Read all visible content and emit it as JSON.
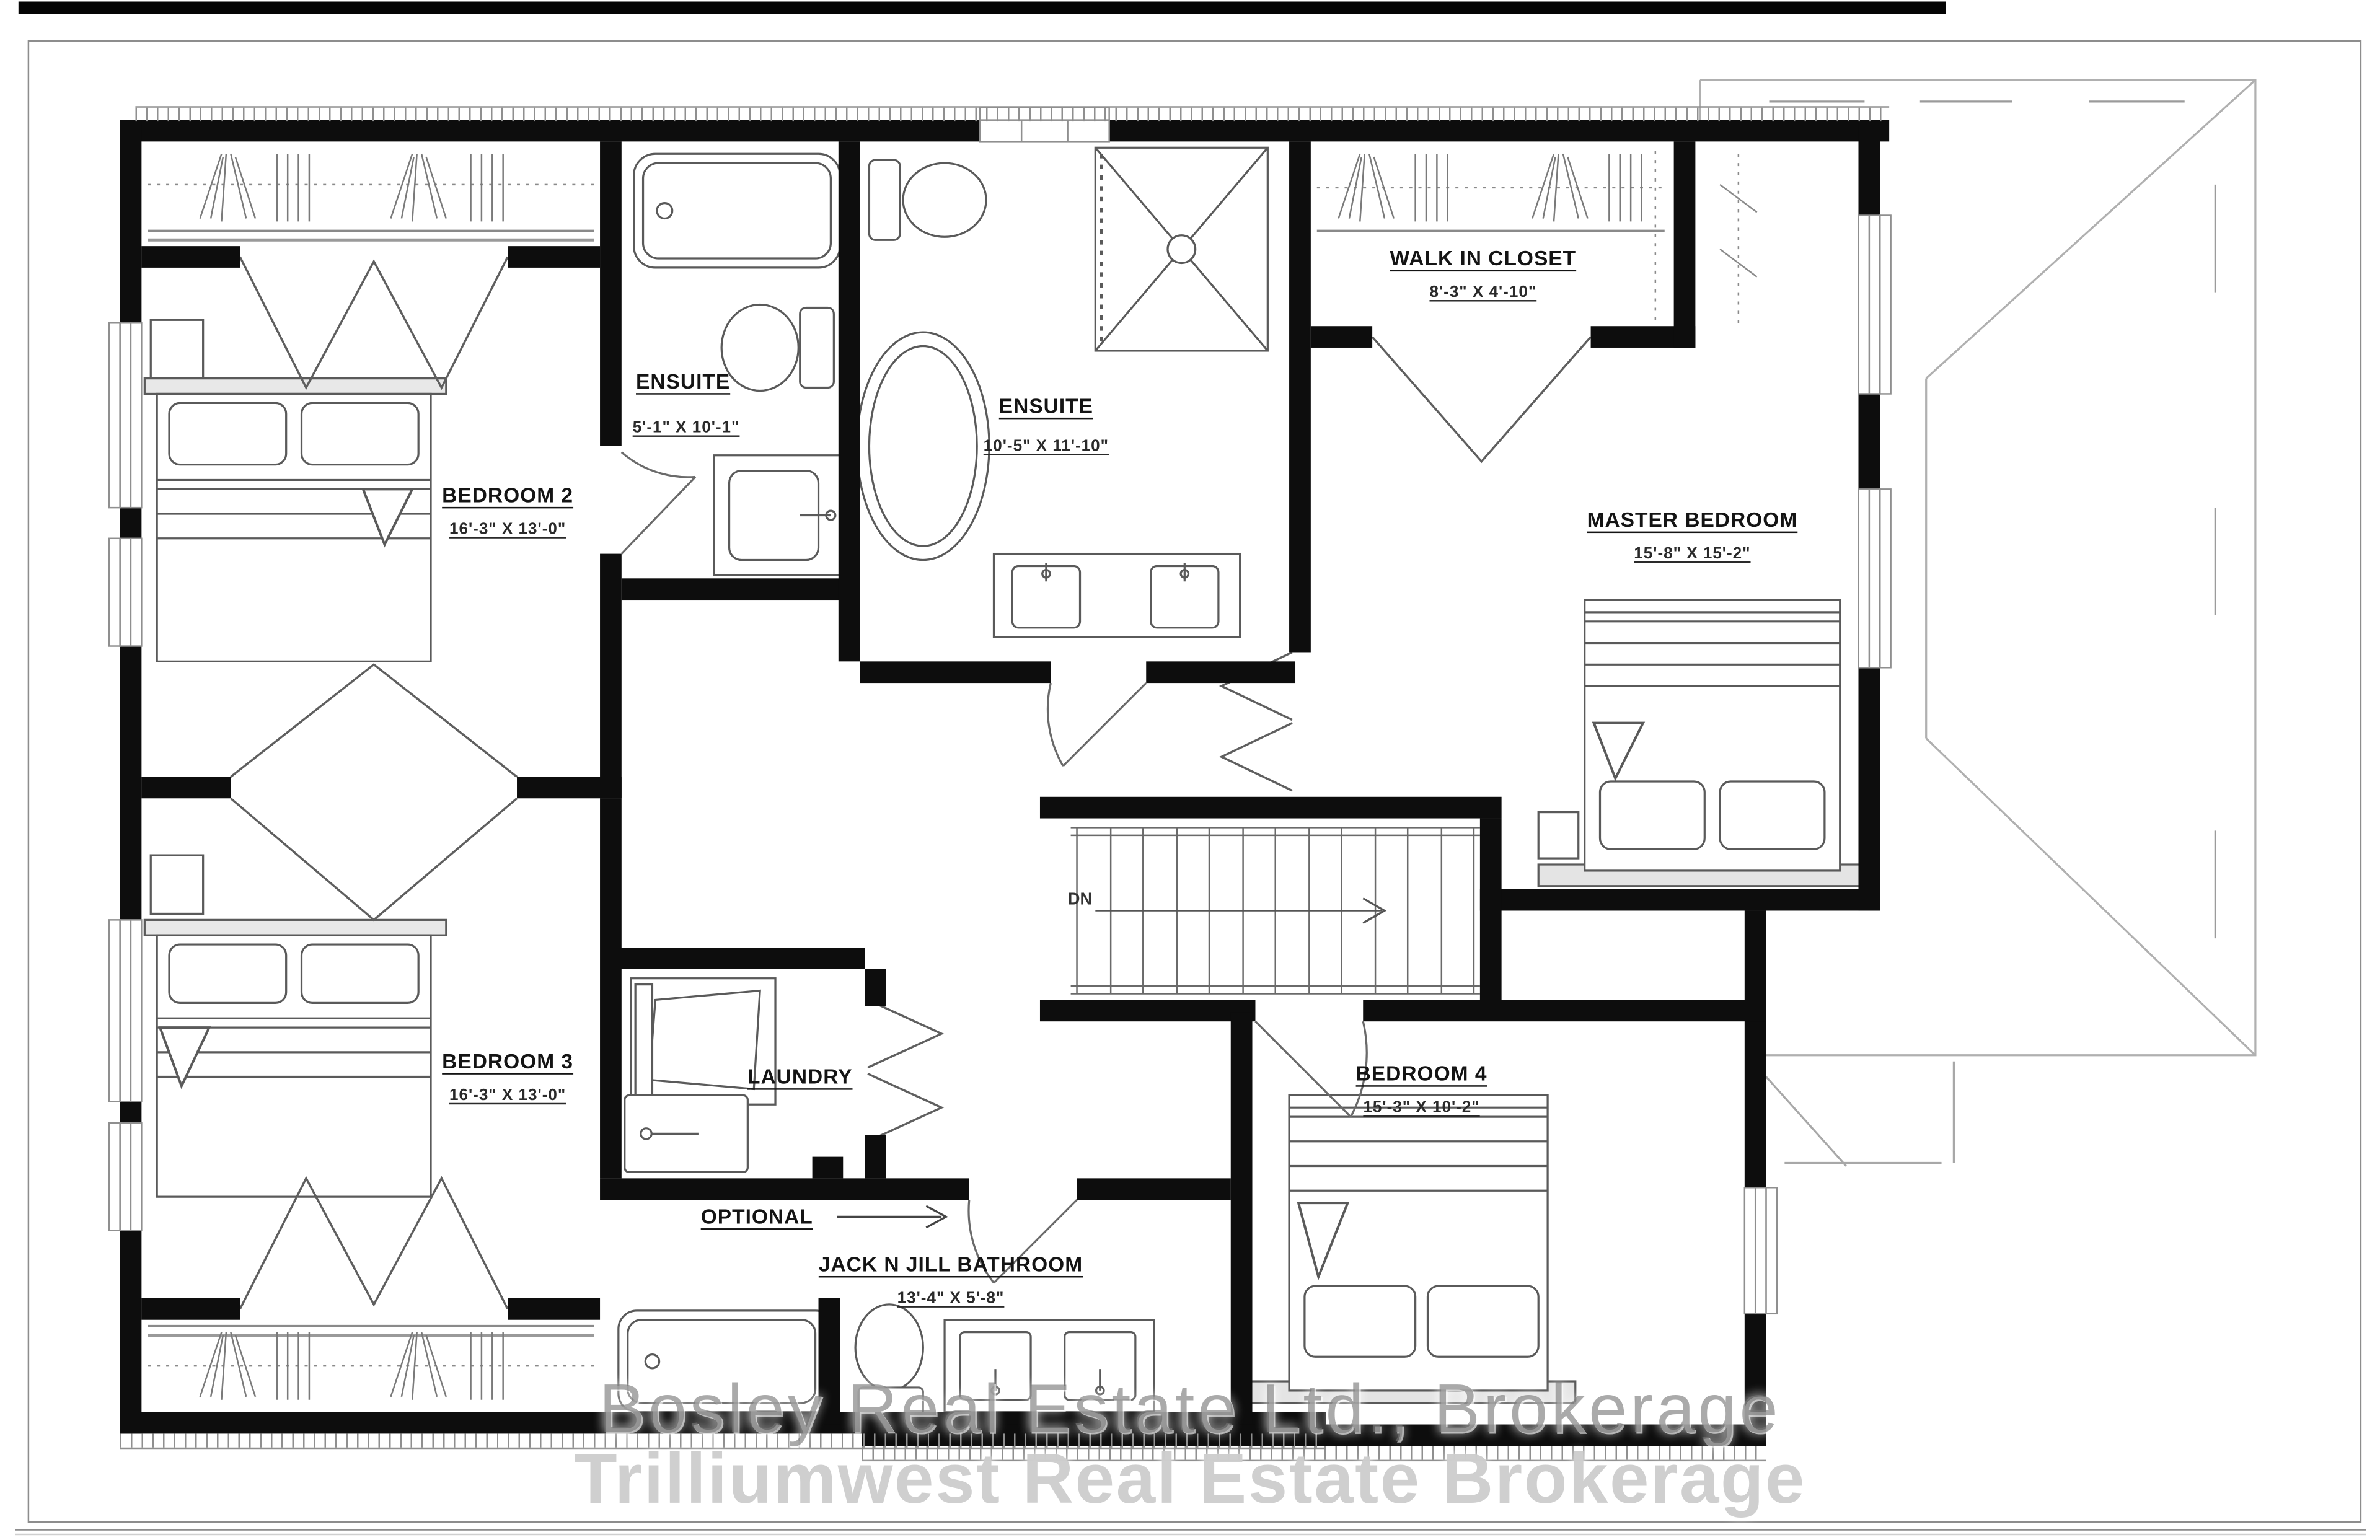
{
  "plan": {
    "rooms": [
      {
        "name": "BEDROOM 2",
        "dims": "16'-3\" X 13'-0\""
      },
      {
        "name": "ENSUITE",
        "dims": "5'-1\" X 10'-1\""
      },
      {
        "name": "ENSUITE",
        "dims": "10'-5\" X 11'-10\""
      },
      {
        "name": "WALK IN CLOSET",
        "dims": "8'-3\" X 4'-10\""
      },
      {
        "name": "MASTER BEDROOM",
        "dims": "15'-8\" X 15'-2\""
      },
      {
        "name": "BEDROOM 3",
        "dims": "16'-3\" X 13'-0\""
      },
      {
        "name": "LAUNDRY",
        "dims": ""
      },
      {
        "name": "OPTIONAL",
        "dims": ""
      },
      {
        "name": "JACK N JILL BATHROOM",
        "dims": "13'-4\" X 5'-8\""
      },
      {
        "name": "BEDROOM 4",
        "dims": "15'-3\" X 10'-2\""
      }
    ],
    "stairs_label": "DN",
    "watermark": {
      "line1": "Bosley Real Estate Ltd., Brokerage",
      "line2": "Trilliumwest Real Estate Brokerage"
    },
    "colors": {
      "wall": "#0d0d0d",
      "fixture_line": "#5a5a5a",
      "roof_line": "#b0b0b0",
      "watermark1": "#767676",
      "watermark2": "#cccccc"
    }
  }
}
